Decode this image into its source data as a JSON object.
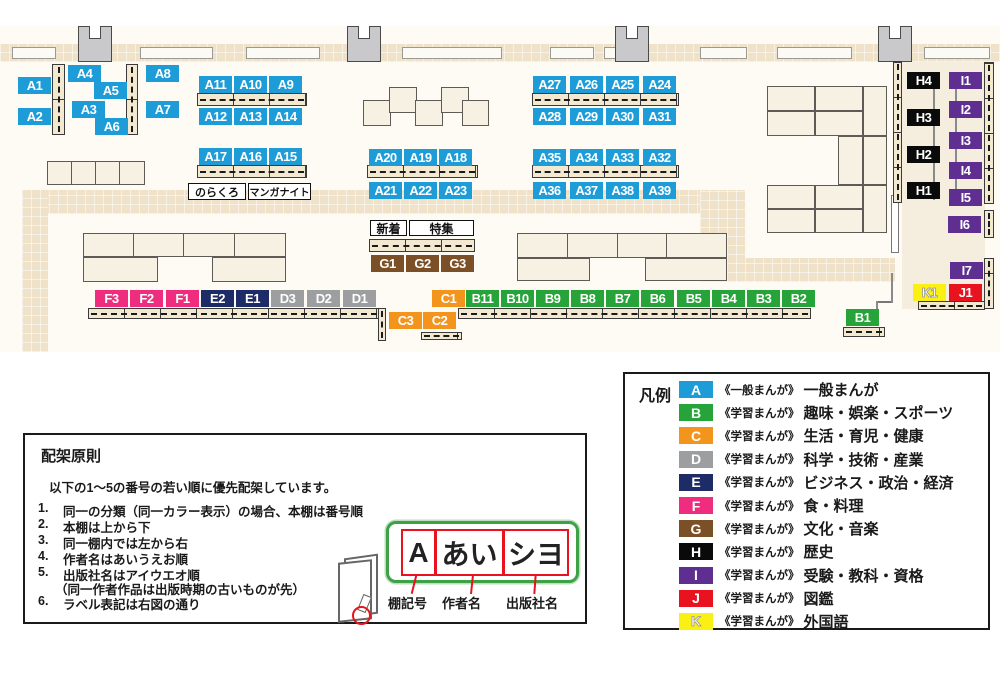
{
  "legend": {
    "title": "凡例",
    "categories": [
      {
        "code": "A",
        "color": "#1E9CD8",
        "series": "《一般まんが》",
        "label": "一般まんが"
      },
      {
        "code": "B",
        "color": "#27A439",
        "series": "《学習まんが》",
        "label": "趣味・娯楽・スポーツ"
      },
      {
        "code": "C",
        "color": "#F3941C",
        "series": "《学習まんが》",
        "label": "生活・育児・健康"
      },
      {
        "code": "D",
        "color": "#9C9EA0",
        "series": "《学習まんが》",
        "label": "科学・技術・産業"
      },
      {
        "code": "E",
        "color": "#1D2B66",
        "series": "《学習まんが》",
        "label": "ビジネス・政治・経済"
      },
      {
        "code": "F",
        "color": "#EE2D7F",
        "series": "《学習まんが》",
        "label": "食・料理"
      },
      {
        "code": "G",
        "color": "#7C5026",
        "series": "《学習まんが》",
        "label": "文化・音楽"
      },
      {
        "code": "H",
        "color": "#0A0A0A",
        "series": "《学習まんが》",
        "label": "歴史"
      },
      {
        "code": "I",
        "color": "#5F2E91",
        "series": "《学習まんが》",
        "label": "受験・教科・資格"
      },
      {
        "code": "J",
        "color": "#E8131E",
        "series": "《学習まんが》",
        "label": "図鑑"
      },
      {
        "code": "K",
        "color": "#FAF013",
        "series": "《学習まんが》",
        "label": "外国語"
      }
    ]
  },
  "map": {
    "shelf_labels": [
      "A1",
      "A2",
      "A3",
      "A4",
      "A5",
      "A6",
      "A7",
      "A8",
      "A9",
      "A10",
      "A11",
      "A12",
      "A13",
      "A14",
      "A15",
      "A16",
      "A17",
      "A18",
      "A19",
      "A20",
      "A21",
      "A22",
      "A23",
      "A24",
      "A25",
      "A26",
      "A27",
      "A28",
      "A29",
      "A30",
      "A31",
      "A32",
      "A33",
      "A34",
      "A35",
      "A36",
      "A37",
      "A38",
      "A39",
      "B1",
      "B2",
      "B3",
      "B4",
      "B5",
      "B6",
      "B7",
      "B8",
      "B9",
      "B10",
      "B11",
      "C1",
      "C2",
      "C3",
      "D1",
      "D2",
      "D3",
      "E1",
      "E2",
      "F1",
      "F2",
      "F3",
      "G1",
      "G2",
      "G3",
      "H1",
      "H2",
      "H3",
      "H4",
      "I1",
      "I2",
      "I3",
      "I4",
      "I5",
      "I6",
      "I7",
      "J1",
      "K1"
    ],
    "annotations": [
      {
        "id": "norakuro",
        "text": "のらくろ"
      },
      {
        "id": "manga-night",
        "text": "マンガナイト"
      },
      {
        "id": "new-arrivals",
        "text": "新着"
      },
      {
        "id": "feature",
        "text": "特集"
      }
    ]
  },
  "principles": {
    "title": "配架原則",
    "intro": "以下の1～5の番号の若い順に優先配架しています。",
    "items": [
      "同一の分類（同一カラー表示）の場合、本棚は番号順",
      "本棚は上から下",
      "同一棚内では左から右",
      "作者名はあいうえお順",
      "出版社名はアイウエオ順",
      "ラベル表記は右図の通り"
    ],
    "item5_note": "（同一作者作品は出版時期の古いものが先）",
    "label_example": {
      "shelf": "A",
      "author": "あい",
      "publisher": "シヨ"
    },
    "label_captions": {
      "shelf": "棚記号",
      "author": "作者名",
      "publisher": "出版社名"
    }
  }
}
